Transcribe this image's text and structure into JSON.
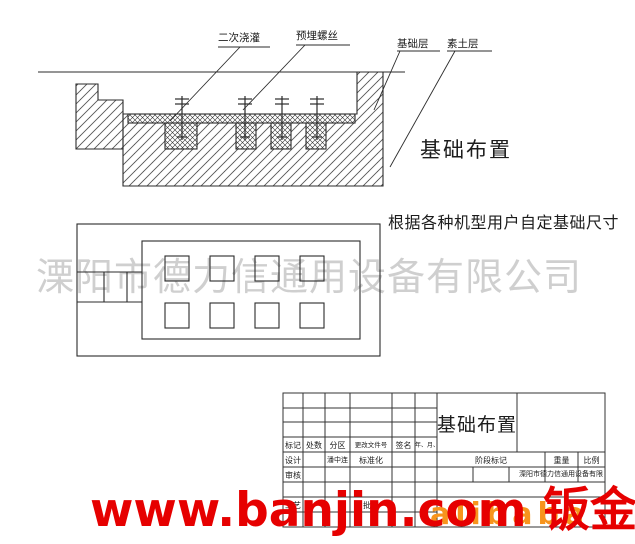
{
  "drawing": {
    "section": {
      "callouts": [
        "二次浇灌",
        "预埋螺丝",
        "基础层",
        "素土层"
      ],
      "caption": "基础布置"
    },
    "note": "根据各种机型用户自定基础尺寸"
  },
  "title_block": {
    "title": "基础布置",
    "header_row": [
      "标记",
      "处数",
      "分区",
      "更改文件号",
      "签名",
      "年、月、日"
    ],
    "designer_label": "设计",
    "designer_name": "潘中连",
    "standardization_label": "标准化",
    "checker_label": "审核",
    "process_label": "工艺",
    "approver_label": "批准",
    "stage_label": "阶段标记",
    "weight_label": "重量",
    "scale_label": "比例",
    "company": "溧阳市德力信通用设备有限公司"
  },
  "watermarks": {
    "company": "溧阳市德力信通用设备有限公司",
    "site": "www.banjin.com 钣金",
    "platform": "alibaba"
  },
  "colors": {
    "line": "#2b2b2b",
    "watermark_gray": "#c4c4c4",
    "watermark_red": "#e60000",
    "watermark_orange": "#f7941d"
  }
}
